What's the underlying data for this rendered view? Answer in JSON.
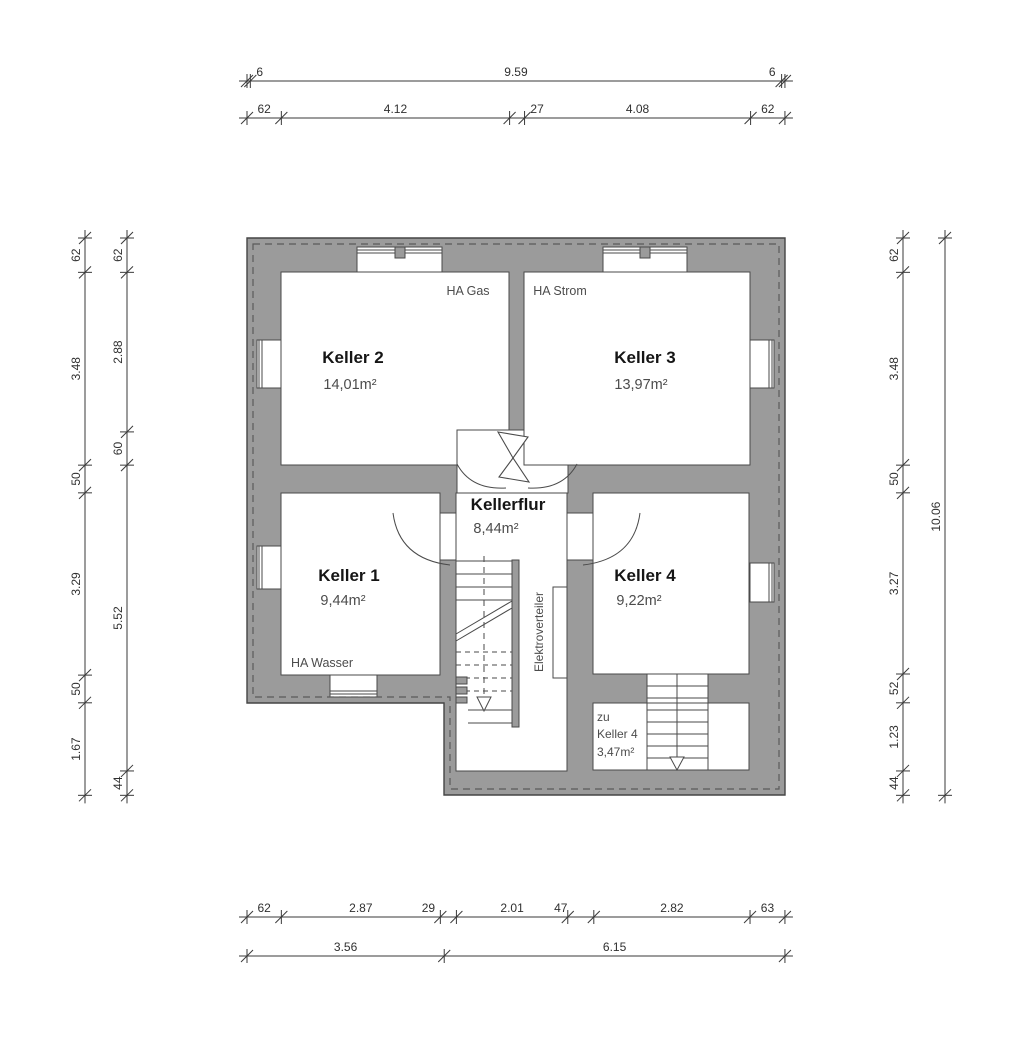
{
  "rooms": {
    "keller2": {
      "name": "Keller 2",
      "area": "14,01m²"
    },
    "keller3": {
      "name": "Keller 3",
      "area": "13,97m²"
    },
    "keller1": {
      "name": "Keller 1",
      "area": "9,44m²"
    },
    "keller4": {
      "name": "Keller 4",
      "area": "9,22m²"
    },
    "kellerflur": {
      "name": "Kellerflur",
      "area": "8,44m²"
    },
    "zu_keller4": {
      "line1": "zu",
      "line2": "Keller 4",
      "area": "3,47m²"
    }
  },
  "labels": {
    "ha_gas": "HA Gas",
    "ha_strom": "HA Strom",
    "ha_wasser": "HA Wasser",
    "elektroverteiler": "Elektroverteiler"
  },
  "dims": {
    "top_outer": [
      "6",
      "9.59",
      "6"
    ],
    "top_inner": [
      "62",
      "4.12",
      "27",
      "4.08",
      "62"
    ],
    "bottom_inner": [
      "62",
      "2.87",
      "29",
      "2.01",
      "47",
      "2.82",
      "63"
    ],
    "bottom_outer": [
      "3.56",
      "6.15"
    ],
    "left_outer": [
      "62",
      "3.48",
      "50",
      "3.29",
      "50",
      "1.67"
    ],
    "left_inner": [
      "62",
      "2.88",
      "60",
      "5.52",
      "44"
    ],
    "right_inner": [
      "62",
      "3.48",
      "50",
      "3.27",
      "52",
      "1.23",
      "44"
    ],
    "right_outer": [
      "10.06"
    ]
  },
  "colors": {
    "wall_fill": "#9b9b9b",
    "line": "#4a4a4a",
    "dim_line": "#3a3a3a",
    "background": "#ffffff"
  }
}
